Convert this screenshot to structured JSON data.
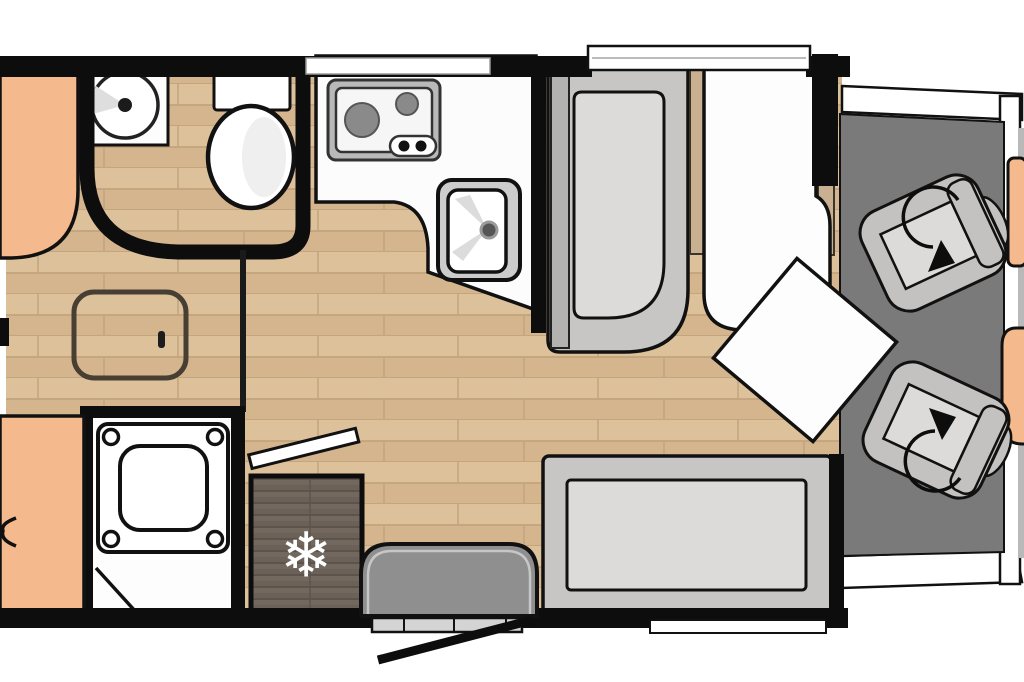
{
  "title": "motorhome-floorplan",
  "icons": {
    "snowflake": "❄",
    "rotation_arrow": "curved-arrow",
    "door_swing": "diagonal-bar"
  },
  "palette": {
    "wall": "#0d0d0d",
    "wood_floor_light": "#dcc19b",
    "wood_floor_dark": "#d0b189",
    "wood_seam": "#b99b74",
    "cab_floor": "#7a7a7a",
    "upholstery_orange": "#f4b98c",
    "furniture_gray": "#c7c6c4",
    "furniture_gray_inner": "#dcdbd9",
    "dark_seat_gray": "#8f8f8f",
    "fridge_wood": "#6b6158",
    "fixture_white": "#fdfdfd",
    "appliance_gray": "#bbbbbb"
  },
  "fixtures": {
    "washbasin": "round basin with tap",
    "toilet": "toilet with cistern",
    "shower": "shower tray",
    "hob": "two-burner hob with controls",
    "sink": "kitchen sink with tap",
    "fridge": "fridge-freezer",
    "wardrobe_bench": "upholstered bench",
    "bed": "made-up bed with duvet",
    "sofa": "bench sofa",
    "travel_seat": "forward seat",
    "cab_seats": "two swivel cab seats",
    "entry_door": "open entry door with step",
    "floor_hatch": "floor storage hatch"
  }
}
